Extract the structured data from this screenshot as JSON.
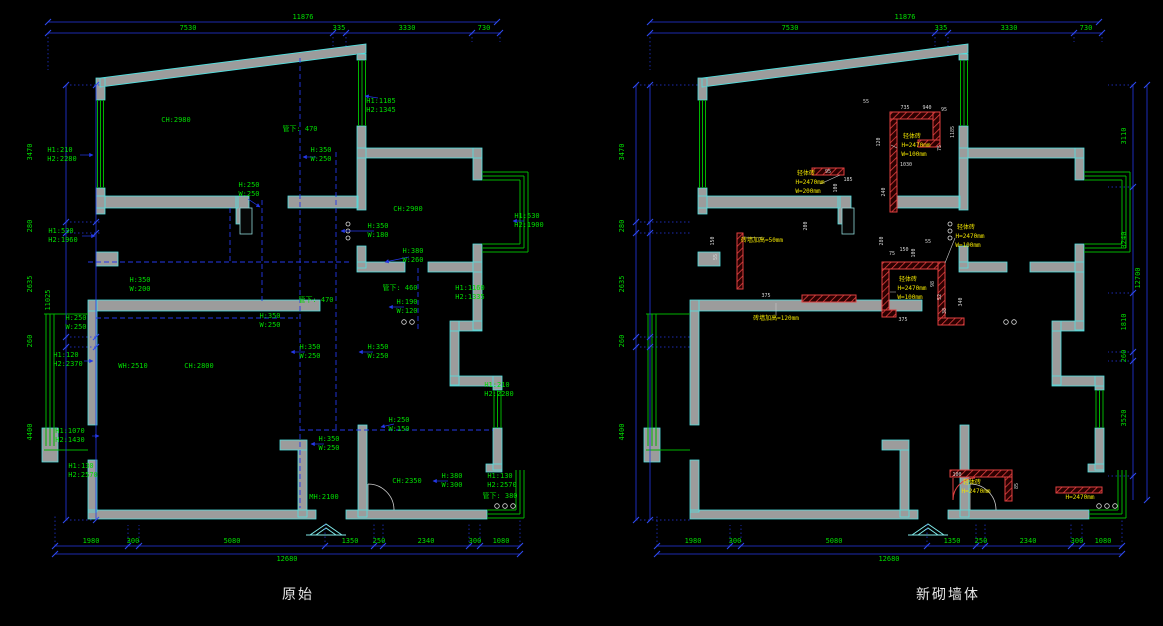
{
  "captions": {
    "left": "原始",
    "right": "新砌墙体"
  },
  "palette": {
    "dim_text": "#00dc00",
    "new_wall_label": "#f0e400",
    "wall_fill": "#9c9c9c",
    "wall_edge": "#4fe3e3",
    "dim_line": "#2438e8",
    "new_wall": "#e04040",
    "background": "#000000"
  },
  "plans": {
    "left": {
      "annotations": [
        {
          "t": "11876",
          "x": 303,
          "y": 19
        },
        {
          "t": "7530",
          "x": 188,
          "y": 30
        },
        {
          "t": "335",
          "x": 339,
          "y": 30
        },
        {
          "t": "3330",
          "x": 407,
          "y": 30
        },
        {
          "t": "730",
          "x": 484,
          "y": 30
        },
        {
          "t": "11025",
          "x": 50,
          "y": 300,
          "r": 1
        },
        {
          "t": "3470",
          "x": 32,
          "y": 152,
          "r": 1
        },
        {
          "t": "280",
          "x": 32,
          "y": 226,
          "r": 1
        },
        {
          "t": "2635",
          "x": 32,
          "y": 284,
          "r": 1
        },
        {
          "t": "260",
          "x": 32,
          "y": 341,
          "r": 1
        },
        {
          "t": "4400",
          "x": 32,
          "y": 432,
          "r": 1
        },
        {
          "t": "1980",
          "x": 91,
          "y": 543
        },
        {
          "t": "300",
          "x": 133,
          "y": 543
        },
        {
          "t": "5080",
          "x": 232,
          "y": 543
        },
        {
          "t": "1350",
          "x": 350,
          "y": 543
        },
        {
          "t": "250",
          "x": 379,
          "y": 543
        },
        {
          "t": "2340",
          "x": 426,
          "y": 543
        },
        {
          "t": "300",
          "x": 475,
          "y": 543
        },
        {
          "t": "1080",
          "x": 501,
          "y": 543
        },
        {
          "t": "12680",
          "x": 287,
          "y": 561
        },
        {
          "t": "CH:2980",
          "x": 176,
          "y": 122
        },
        {
          "t": "管下: 470",
          "x": 300,
          "y": 131
        },
        {
          "t": "H1:1185",
          "x": 381,
          "y": 103
        },
        {
          "t": "H2:1345",
          "x": 381,
          "y": 112
        },
        {
          "t": "H1:210",
          "x": 60,
          "y": 152
        },
        {
          "t": "H2:2280",
          "x": 62,
          "y": 161
        },
        {
          "t": "H:250",
          "x": 249,
          "y": 187
        },
        {
          "t": "W:250",
          "x": 249,
          "y": 196
        },
        {
          "t": "H:350",
          "x": 321,
          "y": 152
        },
        {
          "t": "W:250",
          "x": 321,
          "y": 161
        },
        {
          "t": "H1:530",
          "x": 61,
          "y": 233
        },
        {
          "t": "H2:1960",
          "x": 63,
          "y": 242
        },
        {
          "t": "CH:2900",
          "x": 408,
          "y": 211
        },
        {
          "t": "H:350",
          "x": 378,
          "y": 228
        },
        {
          "t": "W:180",
          "x": 378,
          "y": 237
        },
        {
          "t": "H:380",
          "x": 413,
          "y": 253
        },
        {
          "t": "W:260",
          "x": 413,
          "y": 262
        },
        {
          "t": "H1:530",
          "x": 527,
          "y": 218
        },
        {
          "t": "H2:1900",
          "x": 529,
          "y": 227
        },
        {
          "t": "管下: 470",
          "x": 316,
          "y": 302
        },
        {
          "t": "管下: 460",
          "x": 400,
          "y": 290
        },
        {
          "t": "H:190",
          "x": 407,
          "y": 304
        },
        {
          "t": "W:120",
          "x": 407,
          "y": 313
        },
        {
          "t": "H1:1160",
          "x": 470,
          "y": 290
        },
        {
          "t": "H2:1335",
          "x": 470,
          "y": 299
        },
        {
          "t": "H:250",
          "x": 76,
          "y": 320
        },
        {
          "t": "W:250",
          "x": 76,
          "y": 329
        },
        {
          "t": "H:350",
          "x": 140,
          "y": 282
        },
        {
          "t": "W:200",
          "x": 140,
          "y": 291
        },
        {
          "t": "H:350",
          "x": 270,
          "y": 318
        },
        {
          "t": "W:250",
          "x": 270,
          "y": 327
        },
        {
          "t": "H:350",
          "x": 310,
          "y": 349
        },
        {
          "t": "W:250",
          "x": 310,
          "y": 358
        },
        {
          "t": "H:350",
          "x": 378,
          "y": 349
        },
        {
          "t": "W:250",
          "x": 378,
          "y": 358
        },
        {
          "t": "H1:210",
          "x": 497,
          "y": 387
        },
        {
          "t": "H2:2280",
          "x": 499,
          "y": 396
        },
        {
          "t": "WH:2510",
          "x": 133,
          "y": 368
        },
        {
          "t": "CH:2800",
          "x": 199,
          "y": 368
        },
        {
          "t": "H1:120",
          "x": 66,
          "y": 357
        },
        {
          "t": "H2:2370",
          "x": 68,
          "y": 366
        },
        {
          "t": "H:250",
          "x": 399,
          "y": 422
        },
        {
          "t": "W:150",
          "x": 399,
          "y": 431
        },
        {
          "t": "H:350",
          "x": 329,
          "y": 441
        },
        {
          "t": "W:250",
          "x": 329,
          "y": 450
        },
        {
          "t": "H1:1070",
          "x": 70,
          "y": 433
        },
        {
          "t": "H2:1430",
          "x": 70,
          "y": 442
        },
        {
          "t": "H1:130",
          "x": 81,
          "y": 468
        },
        {
          "t": "H2:2570",
          "x": 83,
          "y": 477
        },
        {
          "t": "CH:2350",
          "x": 407,
          "y": 483
        },
        {
          "t": "H:380",
          "x": 452,
          "y": 478
        },
        {
          "t": "W:300",
          "x": 452,
          "y": 487
        },
        {
          "t": "H1:130",
          "x": 500,
          "y": 478
        },
        {
          "t": "H2:2570",
          "x": 502,
          "y": 487
        },
        {
          "t": "管下: 380",
          "x": 500,
          "y": 498
        },
        {
          "t": "MH:2100",
          "x": 324,
          "y": 499
        }
      ]
    },
    "right": {
      "annotations": [
        {
          "t": "11876",
          "x": 905,
          "y": 19
        },
        {
          "t": "7530",
          "x": 790,
          "y": 30
        },
        {
          "t": "335",
          "x": 941,
          "y": 30
        },
        {
          "t": "3330",
          "x": 1009,
          "y": 30
        },
        {
          "t": "730",
          "x": 1086,
          "y": 30
        },
        {
          "t": "3470",
          "x": 624,
          "y": 152,
          "r": 1
        },
        {
          "t": "280",
          "x": 624,
          "y": 226,
          "r": 1
        },
        {
          "t": "2635",
          "x": 624,
          "y": 284,
          "r": 1
        },
        {
          "t": "260",
          "x": 624,
          "y": 341,
          "r": 1
        },
        {
          "t": "4400",
          "x": 624,
          "y": 432,
          "r": 1
        },
        {
          "t": "1980",
          "x": 693,
          "y": 543
        },
        {
          "t": "300",
          "x": 735,
          "y": 543
        },
        {
          "t": "5080",
          "x": 834,
          "y": 543
        },
        {
          "t": "1350",
          "x": 952,
          "y": 543
        },
        {
          "t": "250",
          "x": 981,
          "y": 543
        },
        {
          "t": "2340",
          "x": 1028,
          "y": 543
        },
        {
          "t": "300",
          "x": 1077,
          "y": 543
        },
        {
          "t": "1080",
          "x": 1103,
          "y": 543
        },
        {
          "t": "12680",
          "x": 889,
          "y": 561
        },
        {
          "t": "3110",
          "x": 1126,
          "y": 136,
          "r": 1
        },
        {
          "t": "3240",
          "x": 1126,
          "y": 240,
          "r": 1
        },
        {
          "t": "1810",
          "x": 1126,
          "y": 322,
          "r": 1
        },
        {
          "t": "260",
          "x": 1126,
          "y": 356,
          "r": 1
        },
        {
          "t": "3520",
          "x": 1126,
          "y": 418,
          "r": 1
        },
        {
          "t": "12700",
          "x": 1140,
          "y": 278,
          "r": 1
        },
        {
          "t": "轻体砖",
          "x": 912,
          "y": 138,
          "c": "y"
        },
        {
          "t": "H=2470mm",
          "x": 916,
          "y": 147,
          "c": "y"
        },
        {
          "t": "W=100mm",
          "x": 914,
          "y": 156,
          "c": "y"
        },
        {
          "t": "轻体砖",
          "x": 806,
          "y": 175,
          "c": "y"
        },
        {
          "t": "H=2470mm",
          "x": 810,
          "y": 184,
          "c": "y"
        },
        {
          "t": "W=200mm",
          "x": 808,
          "y": 193,
          "c": "y"
        },
        {
          "t": "轻体砖",
          "x": 966,
          "y": 229,
          "c": "y"
        },
        {
          "t": "H=2470mm",
          "x": 970,
          "y": 238,
          "c": "y"
        },
        {
          "t": "W=100mm",
          "x": 968,
          "y": 247,
          "c": "y"
        },
        {
          "t": "轻体砖",
          "x": 908,
          "y": 281,
          "c": "y"
        },
        {
          "t": "H=2470mm",
          "x": 912,
          "y": 290,
          "c": "y"
        },
        {
          "t": "W=100mm",
          "x": 910,
          "y": 299,
          "c": "y"
        },
        {
          "t": "砖墙加高=50mm",
          "x": 762,
          "y": 242,
          "c": "y"
        },
        {
          "t": "砖墙加高=120mm",
          "x": 776,
          "y": 320,
          "c": "y"
        },
        {
          "t": "轻体砖",
          "x": 972,
          "y": 484,
          "c": "y"
        },
        {
          "t": "H=2470mm",
          "x": 976,
          "y": 493,
          "c": "y"
        },
        {
          "t": "H=2470mm",
          "x": 1080,
          "y": 499,
          "c": "y"
        },
        {
          "t": "735",
          "x": 905,
          "y": 109,
          "c": "w"
        },
        {
          "t": "940",
          "x": 927,
          "y": 109,
          "c": "w"
        },
        {
          "t": "95",
          "x": 944,
          "y": 111,
          "c": "w"
        },
        {
          "t": "55",
          "x": 866,
          "y": 103,
          "c": "w"
        },
        {
          "t": "120",
          "x": 880,
          "y": 142,
          "c": "w",
          "r": 1
        },
        {
          "t": "1030",
          "x": 906,
          "y": 166,
          "c": "w"
        },
        {
          "t": "75",
          "x": 941,
          "y": 148,
          "c": "w",
          "r": 1
        },
        {
          "t": "240",
          "x": 885,
          "y": 192,
          "c": "w",
          "r": 1
        },
        {
          "t": "95",
          "x": 828,
          "y": 173,
          "c": "w"
        },
        {
          "t": "100",
          "x": 837,
          "y": 188,
          "c": "w",
          "r": 1
        },
        {
          "t": "200",
          "x": 807,
          "y": 226,
          "c": "w",
          "r": 1
        },
        {
          "t": "185",
          "x": 848,
          "y": 181,
          "c": "w"
        },
        {
          "t": "150",
          "x": 714,
          "y": 241,
          "c": "w",
          "r": 1
        },
        {
          "t": "55",
          "x": 717,
          "y": 257,
          "c": "w",
          "r": 1
        },
        {
          "t": "375",
          "x": 766,
          "y": 297,
          "c": "w"
        },
        {
          "t": "280",
          "x": 883,
          "y": 241,
          "c": "w",
          "r": 1
        },
        {
          "t": "75",
          "x": 892,
          "y": 255,
          "c": "w"
        },
        {
          "t": "150",
          "x": 904,
          "y": 251,
          "c": "w"
        },
        {
          "t": "100",
          "x": 915,
          "y": 253,
          "c": "w",
          "r": 1
        },
        {
          "t": "55",
          "x": 928,
          "y": 243,
          "c": "w"
        },
        {
          "t": "98",
          "x": 934,
          "y": 284,
          "c": "w",
          "r": 1
        },
        {
          "t": "52",
          "x": 941,
          "y": 297,
          "c": "w",
          "r": 1
        },
        {
          "t": "38",
          "x": 946,
          "y": 311,
          "c": "w",
          "r": 1
        },
        {
          "t": "375",
          "x": 903,
          "y": 321,
          "c": "w"
        },
        {
          "t": "1185",
          "x": 954,
          "y": 132,
          "c": "w",
          "r": 1
        },
        {
          "t": "340",
          "x": 962,
          "y": 302,
          "c": "w",
          "r": 1
        },
        {
          "t": "100",
          "x": 957,
          "y": 476,
          "c": "w"
        },
        {
          "t": "85",
          "x": 1018,
          "y": 486,
          "c": "w",
          "r": 1
        }
      ]
    }
  }
}
